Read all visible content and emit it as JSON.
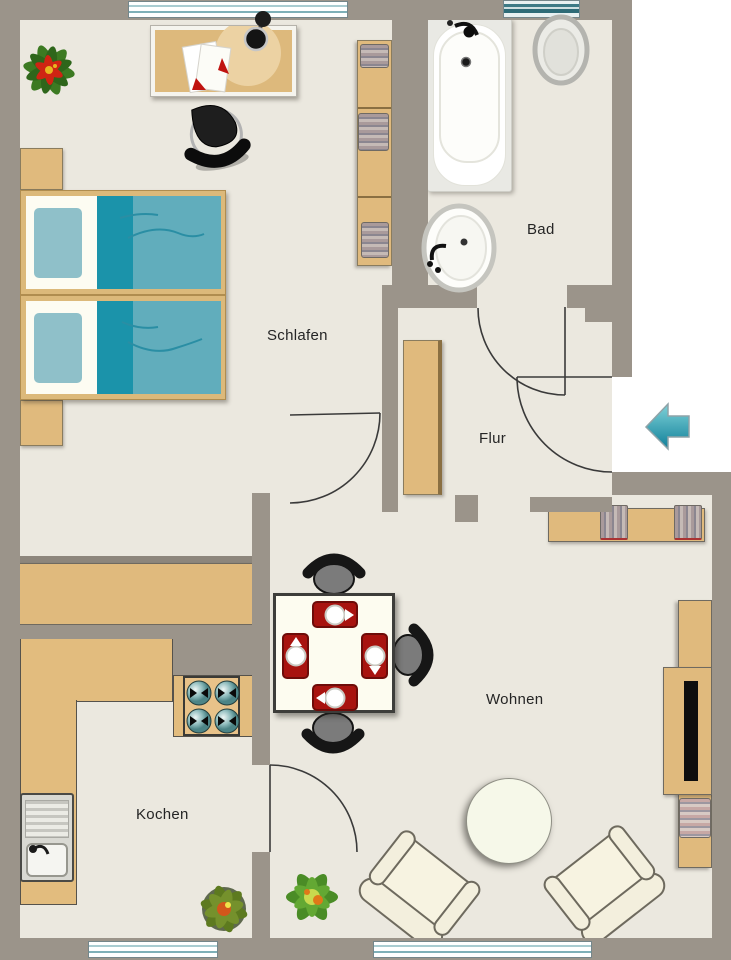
{
  "title": "apartment-floor-plan",
  "rooms": {
    "schlafen": {
      "label": "Schlafen"
    },
    "bad": {
      "label": "Bad"
    },
    "flur": {
      "label": "Flur"
    },
    "wohnen": {
      "label": "Wohnen"
    },
    "kochen": {
      "label": "Kochen"
    }
  },
  "colors": {
    "wall": "#9b948a",
    "floor": "#ebe8df",
    "wood": "#e0ba7d",
    "accent_red": "#a8130f",
    "bed_blanket": "#61adbc",
    "bed_blanket_dark": "#1b93aa",
    "pillow": "#8fc0c9",
    "window_stripe": "#3d7a85",
    "entry_arrow": "#2fa9bc",
    "outside": "#ffffff"
  },
  "icons": {
    "entry_arrow": "left-arrow"
  }
}
